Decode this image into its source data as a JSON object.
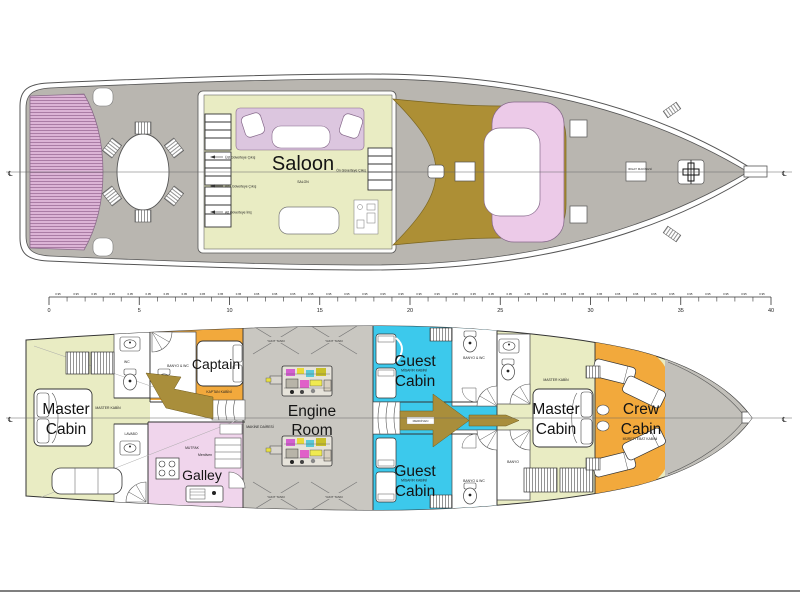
{
  "colors": {
    "deck": "#b9b6b0",
    "roomgreen": "#e9ecc3",
    "sofa": "#dcc6df",
    "mattress_pink": "#dcb4d6",
    "mattress_stripe": "#a576a0",
    "brown": "#ad8f35",
    "bowpink": "#eccae8",
    "orange": "#f2a93c",
    "galleypink": "#f0d5ec",
    "cyan": "#3cc9ec",
    "enginegray": "#c9c7c1",
    "bowgray": "#c2c0ba",
    "arrowbrown": "#a98e3b"
  },
  "upper_deck": {
    "saloon": {
      "label": "Saloon",
      "sublabel": "SALON"
    },
    "exit_labels": {
      "upper": "Üst Güverteye Çıkış",
      "main": "Ana Güverteye Çıkış",
      "lower": "Alt Güverteye İniş",
      "fore": "Ön Güverteye Çıkış"
    },
    "windlass_label": "IRGAT MAKİNESİ",
    "centerline_symbol": "℄"
  },
  "scale_ruler": {
    "major_labels": [
      "0",
      "5",
      "10",
      "15",
      "20",
      "25",
      "30",
      "35",
      "40"
    ],
    "minor_label": "0.95"
  },
  "lower_deck": {
    "master_aft": {
      "line1": "Master",
      "line2": "Cabin",
      "sublabel": "MASTER KABİN"
    },
    "captain": {
      "label": "Captain",
      "sublabel": "KAPTAN KABİNİ"
    },
    "galley": {
      "label": "Galley",
      "sublabel": "MUTFAK"
    },
    "engine_room": {
      "line1": "Engine",
      "line2": "Room",
      "sublabel": "MAKİNE DAİRESİ"
    },
    "guest_upper": {
      "line1": "Guest",
      "line2": "Cabin",
      "sublabel": "MİSAFİR KABİNİ"
    },
    "guest_lower": {
      "line1": "Guest",
      "line2": "Cabin",
      "sublabel": "MİSAFİR KABİNİ"
    },
    "master_fwd": {
      "line1": "Master",
      "line2": "Cabin",
      "sublabel": "MASTER KABİN"
    },
    "crew": {
      "line1": "Crew",
      "line2": "Cabin",
      "sublabel": "MÜRETTEBAT KABİNİ"
    },
    "fuel_tank_label": "YAKIT TANKI",
    "stairs_label": "Merdiven",
    "stairs_label_upper": "MERDİVEN",
    "wc_label": "WC",
    "bath_wc_label": "BANYO & WC",
    "lavabo_label": "LAVABO",
    "banyo_label": "BANYO",
    "centerline_symbol": "℄"
  }
}
